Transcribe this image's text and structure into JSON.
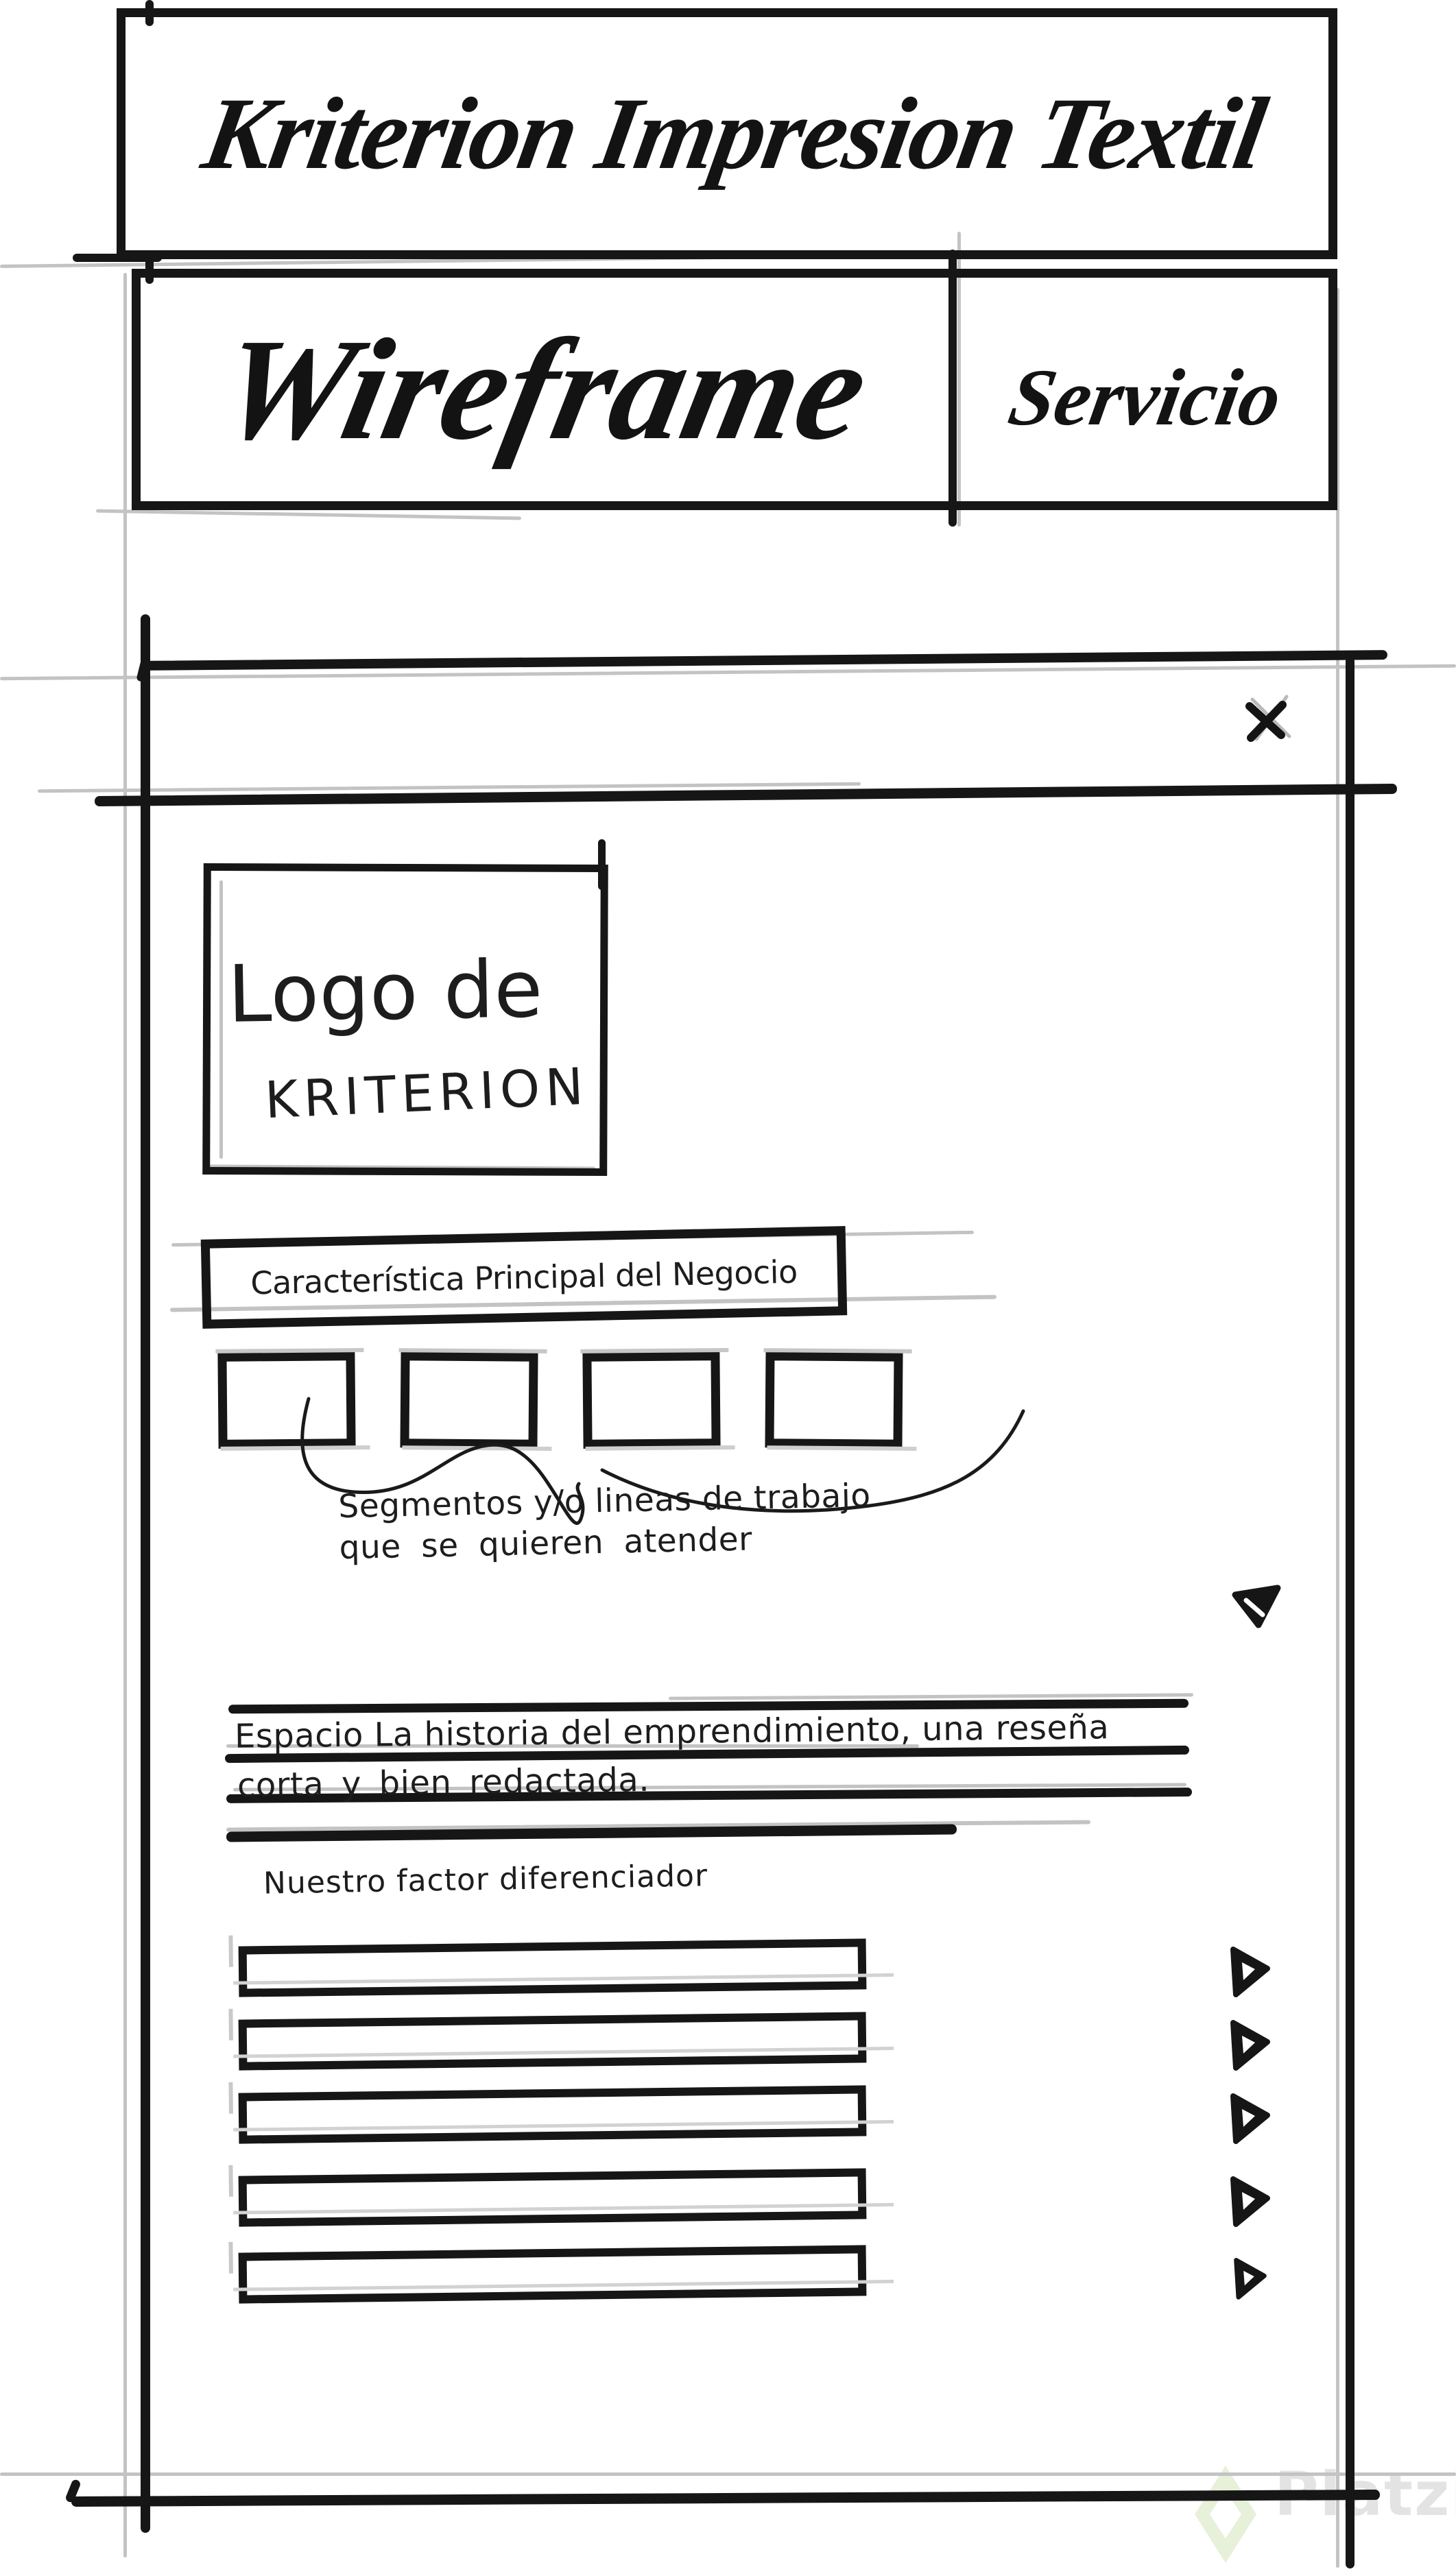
{
  "header": {
    "title": "Kriterion Impresion Textil",
    "wireframe_label": "Wireframe",
    "page_label": "Servicio"
  },
  "modal": {
    "logo": {
      "line1": "Logo de",
      "line2": "KRITERION"
    },
    "banner_label": "Característica Principal del Negocio",
    "segments": {
      "count": 4,
      "annotation": [
        "Segmentos y/o lineas de trabajo",
        "que se quieren atender"
      ]
    },
    "story": {
      "line1": "Espacio La historia del emprendimiento, una reseña",
      "line2": "corta y bien redactada."
    },
    "differentiator": {
      "heading": "Nuestro factor diferenciador",
      "item_count": 5
    }
  },
  "watermark": {
    "brand": "Platzi"
  },
  "colors": {
    "ink": "#161616",
    "guide": "#c3c3c3",
    "watermark_text": "#e3e3e3",
    "watermark_green": "#e7f1d9"
  }
}
